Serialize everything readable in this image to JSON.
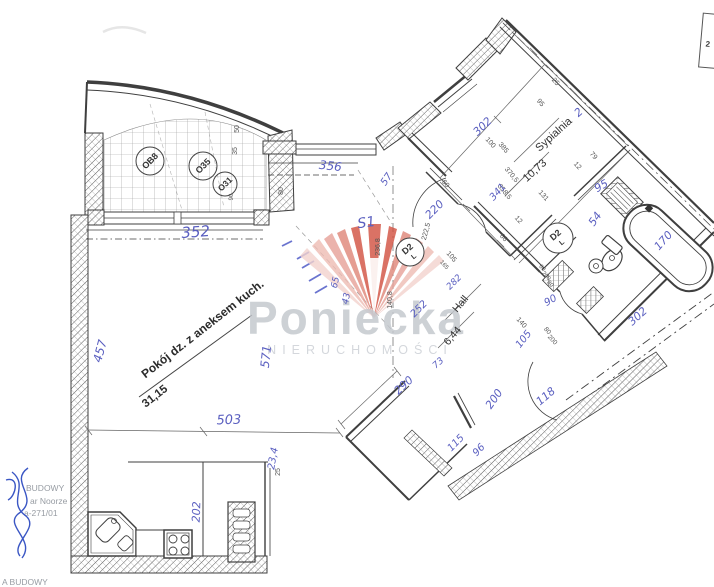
{
  "meta": {
    "type": "scanned apartment floor plan"
  },
  "watermark": {
    "brand": "Poniecka",
    "subtitle": "NIERUCHOMOŚCI",
    "brand_color": "#c3c7cd",
    "subtitle_color": "#cdd1d6",
    "logo_colors": [
      "#f3d3ce",
      "#eebcb4",
      "#e7a198",
      "#df8578",
      "#d14f3f"
    ]
  },
  "corner_box": {
    "label": "2"
  },
  "stamps": {
    "left_lines": [
      "BUDOWY",
      "ar Noorze",
      "a-271/01"
    ],
    "bottom_line": "A BUDOWY",
    "signature_color": "#3a56c4"
  },
  "rooms": [
    {
      "name": "Pokój dz. z aneksem kuch.",
      "area": "31,15"
    },
    {
      "name": "Sypialnia",
      "area": "10,73"
    },
    {
      "name": "Hall",
      "area": "6,44"
    }
  ],
  "doors": [
    {
      "code": "D2",
      "swing": "L"
    },
    {
      "code": "D2",
      "swing": "L"
    }
  ],
  "balcony": {
    "circles": [
      "OB8",
      "O35",
      "O31"
    ]
  },
  "ink_color": "#5a5fc0",
  "print_color": "#555555",
  "annotations": {
    "handwritten": [
      {
        "t": "352",
        "x": 196,
        "y": 237,
        "r": -4,
        "s": 15
      },
      {
        "t": "356",
        "x": 330,
        "y": 170,
        "r": 6,
        "s": 12
      },
      {
        "t": "457",
        "x": 104,
        "y": 352,
        "r": -75,
        "s": 12
      },
      {
        "t": "503",
        "x": 229,
        "y": 424,
        "r": -2,
        "s": 13
      },
      {
        "t": "571",
        "x": 270,
        "y": 357,
        "r": -84,
        "s": 12
      },
      {
        "t": "202",
        "x": 200,
        "y": 512,
        "r": -88,
        "s": 11
      },
      {
        "t": "23,4",
        "x": 276,
        "y": 459,
        "r": -80,
        "s": 10
      },
      {
        "t": "S1",
        "x": 367,
        "y": 227,
        "r": -8,
        "s": 14
      },
      {
        "t": "57",
        "x": 389,
        "y": 181,
        "r": -55,
        "s": 10
      },
      {
        "t": "220",
        "x": 437,
        "y": 212,
        "r": -45,
        "s": 11
      },
      {
        "t": "302",
        "x": 485,
        "y": 129,
        "r": -44,
        "s": 11
      },
      {
        "t": "341",
        "x": 500,
        "y": 194,
        "r": -48,
        "s": 10
      },
      {
        "t": "2",
        "x": 581,
        "y": 115,
        "r": -42,
        "s": 11
      },
      {
        "t": "95",
        "x": 603,
        "y": 189,
        "r": -30,
        "s": 11
      },
      {
        "t": "54",
        "x": 598,
        "y": 221,
        "r": -55,
        "s": 11
      },
      {
        "t": "170",
        "x": 666,
        "y": 243,
        "r": -48,
        "s": 11
      },
      {
        "t": "302",
        "x": 640,
        "y": 319,
        "r": -42,
        "s": 11
      },
      {
        "t": "90",
        "x": 552,
        "y": 303,
        "r": -30,
        "s": 10
      },
      {
        "t": "118",
        "x": 548,
        "y": 399,
        "r": -40,
        "s": 11
      },
      {
        "t": "105",
        "x": 526,
        "y": 341,
        "r": -52,
        "s": 10
      },
      {
        "t": "200",
        "x": 497,
        "y": 401,
        "r": -55,
        "s": 11
      },
      {
        "t": "290",
        "x": 406,
        "y": 388,
        "r": -42,
        "s": 11
      },
      {
        "t": "73",
        "x": 440,
        "y": 365,
        "r": -42,
        "s": 9
      },
      {
        "t": "115",
        "x": 458,
        "y": 445,
        "r": -46,
        "s": 10
      },
      {
        "t": "96",
        "x": 481,
        "y": 452,
        "r": -46,
        "s": 10
      },
      {
        "t": "252",
        "x": 421,
        "y": 311,
        "r": -45,
        "s": 10
      },
      {
        "t": "282",
        "x": 456,
        "y": 284,
        "r": -45,
        "s": 9
      },
      {
        "t": "65",
        "x": 338,
        "y": 283,
        "r": -78,
        "s": 9
      },
      {
        "t": "43",
        "x": 349,
        "y": 299,
        "r": -78,
        "s": 9
      }
    ],
    "printed": [
      {
        "t": "50",
        "x": 239,
        "y": 129,
        "r": -90,
        "s": 7
      },
      {
        "t": "35",
        "x": 237,
        "y": 151,
        "r": -90,
        "s": 7
      },
      {
        "t": "90",
        "x": 233,
        "y": 197,
        "r": -90,
        "s": 6
      },
      {
        "t": "80",
        "x": 283,
        "y": 191,
        "r": -90,
        "s": 7
      },
      {
        "t": "25",
        "x": 554,
        "y": 83,
        "r": 48,
        "s": 7
      },
      {
        "t": "95",
        "x": 539,
        "y": 104,
        "r": 48,
        "s": 7
      },
      {
        "t": "385",
        "x": 502,
        "y": 149,
        "r": 48,
        "s": 7
      },
      {
        "t": "100",
        "x": 489,
        "y": 144,
        "r": 48,
        "s": 7
      },
      {
        "t": "12",
        "x": 576,
        "y": 167,
        "r": 48,
        "s": 7
      },
      {
        "t": "79",
        "x": 592,
        "y": 157,
        "r": 48,
        "s": 7
      },
      {
        "t": "131",
        "x": 542,
        "y": 197,
        "r": 48,
        "s": 7
      },
      {
        "t": "370,5",
        "x": 510,
        "y": 176,
        "r": 50,
        "s": 7
      },
      {
        "t": "358,5",
        "x": 503,
        "y": 193,
        "r": 50,
        "s": 7
      },
      {
        "t": "60",
        "x": 444,
        "y": 185,
        "r": 50,
        "s": 7
      },
      {
        "t": "12",
        "x": 517,
        "y": 221,
        "r": 48,
        "s": 7
      },
      {
        "t": "66",
        "x": 502,
        "y": 239,
        "r": 48,
        "s": 7
      },
      {
        "t": "105",
        "x": 450,
        "y": 258,
        "r": 48,
        "s": 7
      },
      {
        "t": "165",
        "x": 443,
        "y": 266,
        "r": 48,
        "s": 6
      },
      {
        "t": "222,5",
        "x": 428,
        "y": 232,
        "r": -75,
        "s": 7
      },
      {
        "t": "236,8",
        "x": 380,
        "y": 247,
        "r": -90,
        "s": 7
      },
      {
        "t": "140,8",
        "x": 392,
        "y": 300,
        "r": -90,
        "s": 7
      },
      {
        "t": "25",
        "x": 280,
        "y": 472,
        "r": -90,
        "s": 7
      },
      {
        "t": "140",
        "x": 520,
        "y": 324,
        "r": 48,
        "s": 7
      },
      {
        "t": "80",
        "x": 546,
        "y": 332,
        "r": 48,
        "s": 6.5
      },
      {
        "t": "200",
        "x": 551,
        "y": 341,
        "r": 48,
        "s": 6.5
      },
      {
        "t": "60",
        "x": 541,
        "y": 269,
        "r": 48,
        "s": 6
      },
      {
        "t": "200",
        "x": 545,
        "y": 277,
        "r": 48,
        "s": 6
      },
      {
        "t": "80",
        "x": 549,
        "y": 285,
        "r": 48,
        "s": 6
      }
    ]
  }
}
